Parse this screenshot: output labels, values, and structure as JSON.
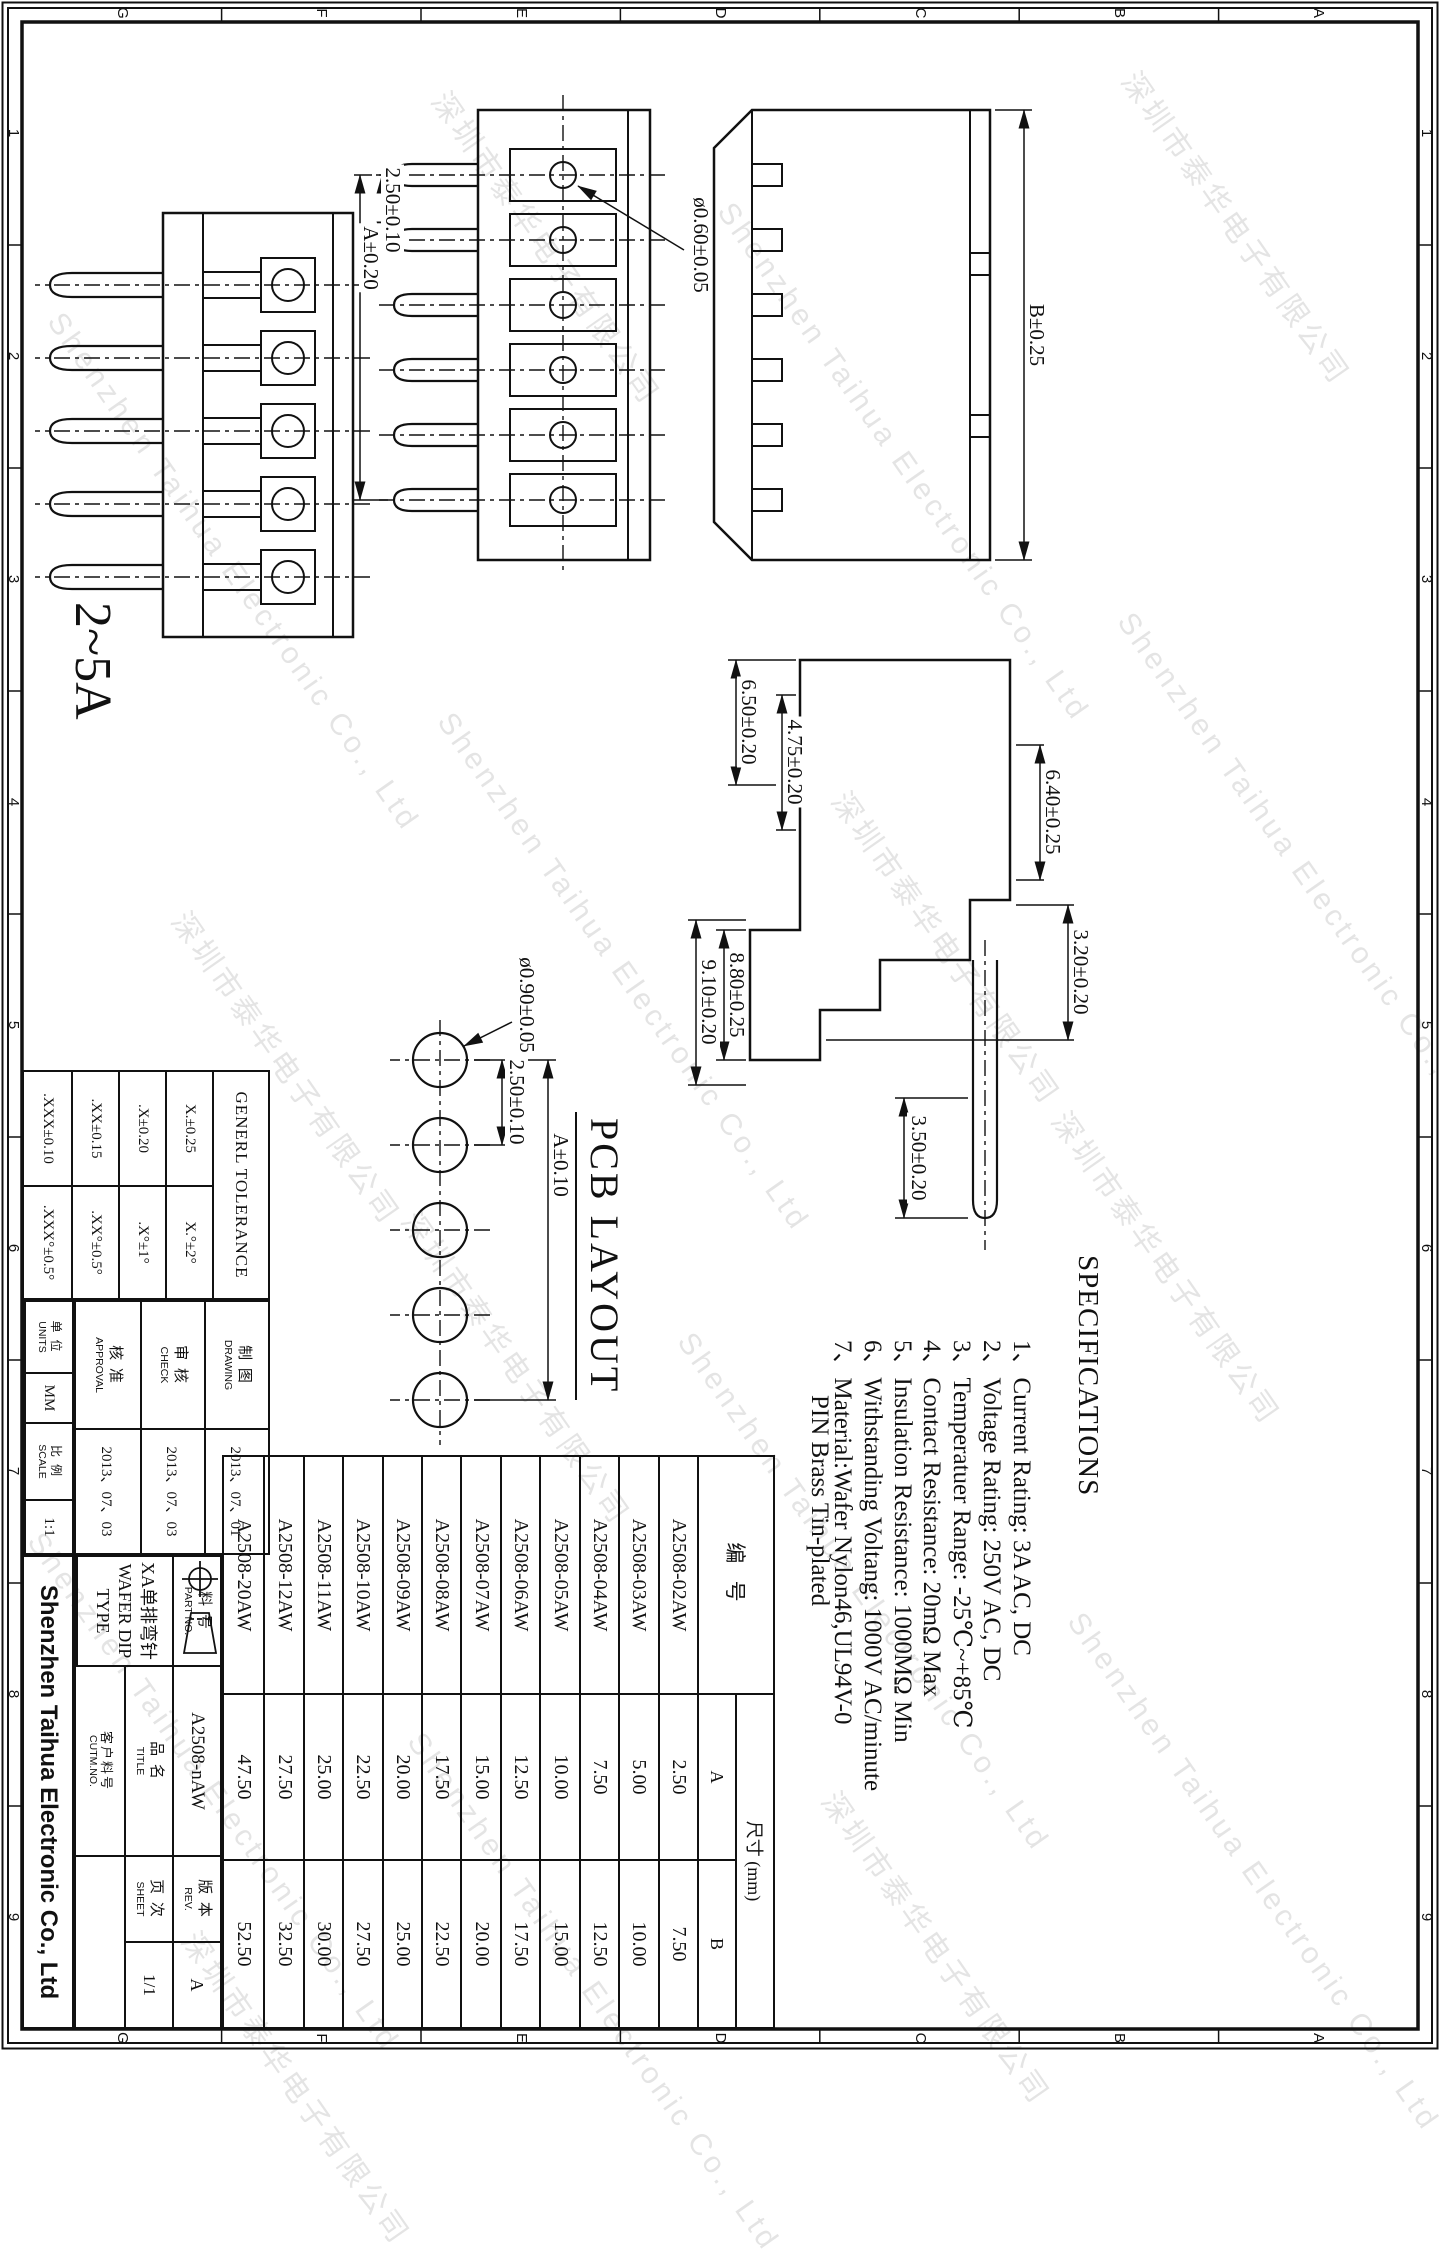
{
  "border": {
    "letters": [
      "A",
      "B",
      "C",
      "D",
      "E",
      "F",
      "G"
    ],
    "numbers": [
      "1",
      "2",
      "3",
      "4",
      "5",
      "6",
      "7",
      "8",
      "9"
    ]
  },
  "watermark": {
    "cn": "深圳市泰华电子有限公司",
    "en": "Shenzhen Taihua Electronic Co., Ltd"
  },
  "views": {
    "rear": {
      "dim_overall": "B±0.25"
    },
    "side6": {
      "dim_pin_dia": "ø0.60±0.05",
      "dim_pitch": "2.50±0.10",
      "dim_span": "A±0.20"
    },
    "front5": {
      "rating_label": "2~5A"
    },
    "profile": {
      "dim_w1": "6.50±0.20",
      "dim_w2": "4.75±0.20",
      "dim_h1": "6.40±0.25",
      "dim_h2": "3.20±0.20",
      "dim_pin_len": "3.50±0.20",
      "dim_d1": "8.80±0.25",
      "dim_d2": "9.10±0.20"
    },
    "pcb": {
      "caption": "PCB LAYOUT",
      "dim_hole": "ø0.90±0.05",
      "dim_pitch": "2.50±0.10",
      "dim_span": "A±0.10"
    }
  },
  "specs": {
    "title": "SPECIFICATIONS",
    "items": [
      "1、Current Rating: 3A AC, DC",
      "2、Voltage Rating: 250V AC, DC",
      "3、Temperatuer Range: -25℃~+85℃",
      "4、Contact Resistance: 20mΩ Max",
      "5、Insulation Resistance: 1000MΩ Min",
      "6、Withstanding Voltang: 1000V AC/minute",
      "7、Material:Wafer Nylon46,UL94V-0",
      "PIN Brass Tin-plated"
    ]
  },
  "parts_table": {
    "col_part": "编  号",
    "col_size": "尺寸 (mm)",
    "col_a": "A",
    "col_b": "B",
    "rows": [
      {
        "pn": "A2508-02AW",
        "a": "2.50",
        "b": "7.50"
      },
      {
        "pn": "A2508-03AW",
        "a": "5.00",
        "b": "10.00"
      },
      {
        "pn": "A2508-04AW",
        "a": "7.50",
        "b": "12.50"
      },
      {
        "pn": "A2508-05AW",
        "a": "10.00",
        "b": "15.00"
      },
      {
        "pn": "A2508-06AW",
        "a": "12.50",
        "b": "17.50"
      },
      {
        "pn": "A2508-07AW",
        "a": "15.00",
        "b": "20.00"
      },
      {
        "pn": "A2508-08AW",
        "a": "17.50",
        "b": "22.50"
      },
      {
        "pn": "A2508-09AW",
        "a": "20.00",
        "b": "25.00"
      },
      {
        "pn": "A2508-10AW",
        "a": "22.50",
        "b": "27.50"
      },
      {
        "pn": "A2508-11AW",
        "a": "25.00",
        "b": "30.00"
      },
      {
        "pn": "A2508-12AW",
        "a": "27.50",
        "b": "32.50"
      },
      {
        "pn": "A2508-20AW",
        "a": "47.50",
        "b": "52.50"
      }
    ]
  },
  "tolerance": {
    "title": "GENERL TOLERANCE",
    "rows": [
      {
        "lin": "X.±0.25",
        "ang": "X.°±2°"
      },
      {
        "lin": ".X±0.20",
        "ang": ".X°±1°"
      },
      {
        "lin": ".XX±0.15",
        "ang": ".XX°±0.5°"
      },
      {
        "lin": ".XXX±0.10",
        "ang": ".XXX°±0.5°"
      }
    ]
  },
  "approvals": {
    "rows": [
      {
        "cn": "制 图",
        "en": "DRAWING",
        "date": "2013、07、01"
      },
      {
        "cn": "审 核",
        "en": "CHECK",
        "date": "2013、07、03"
      },
      {
        "cn": "核 准",
        "en": "APPROVAL",
        "date": "2013、07、03"
      }
    ]
  },
  "title_block": {
    "part_no_label_cn": "料 号",
    "part_no_label_en": "PART NO.",
    "part_no": "A2508-nAW",
    "title_label_cn": "品 名",
    "title_label_en": "TITLE",
    "title_cn": "XA单排弯针",
    "title_en": "WAFER DIP TYPE",
    "cust_label_cn": "客户料号",
    "cust_label_en": "CUTM.NO.",
    "rev_label_cn": "版 本",
    "rev_label_en": "REV.",
    "rev": "A",
    "sheet_label_cn": "页 次",
    "sheet_label_en": "SHEET",
    "sheet": "1/1",
    "units_label_cn": "单 位",
    "units_label_en": "UNITS",
    "units": "MM",
    "scale_label_cn": "比 例",
    "scale_label_en": "SCALE",
    "scale": "1:1",
    "company": "Shenzhen Taihua Electronic Co., Ltd"
  }
}
